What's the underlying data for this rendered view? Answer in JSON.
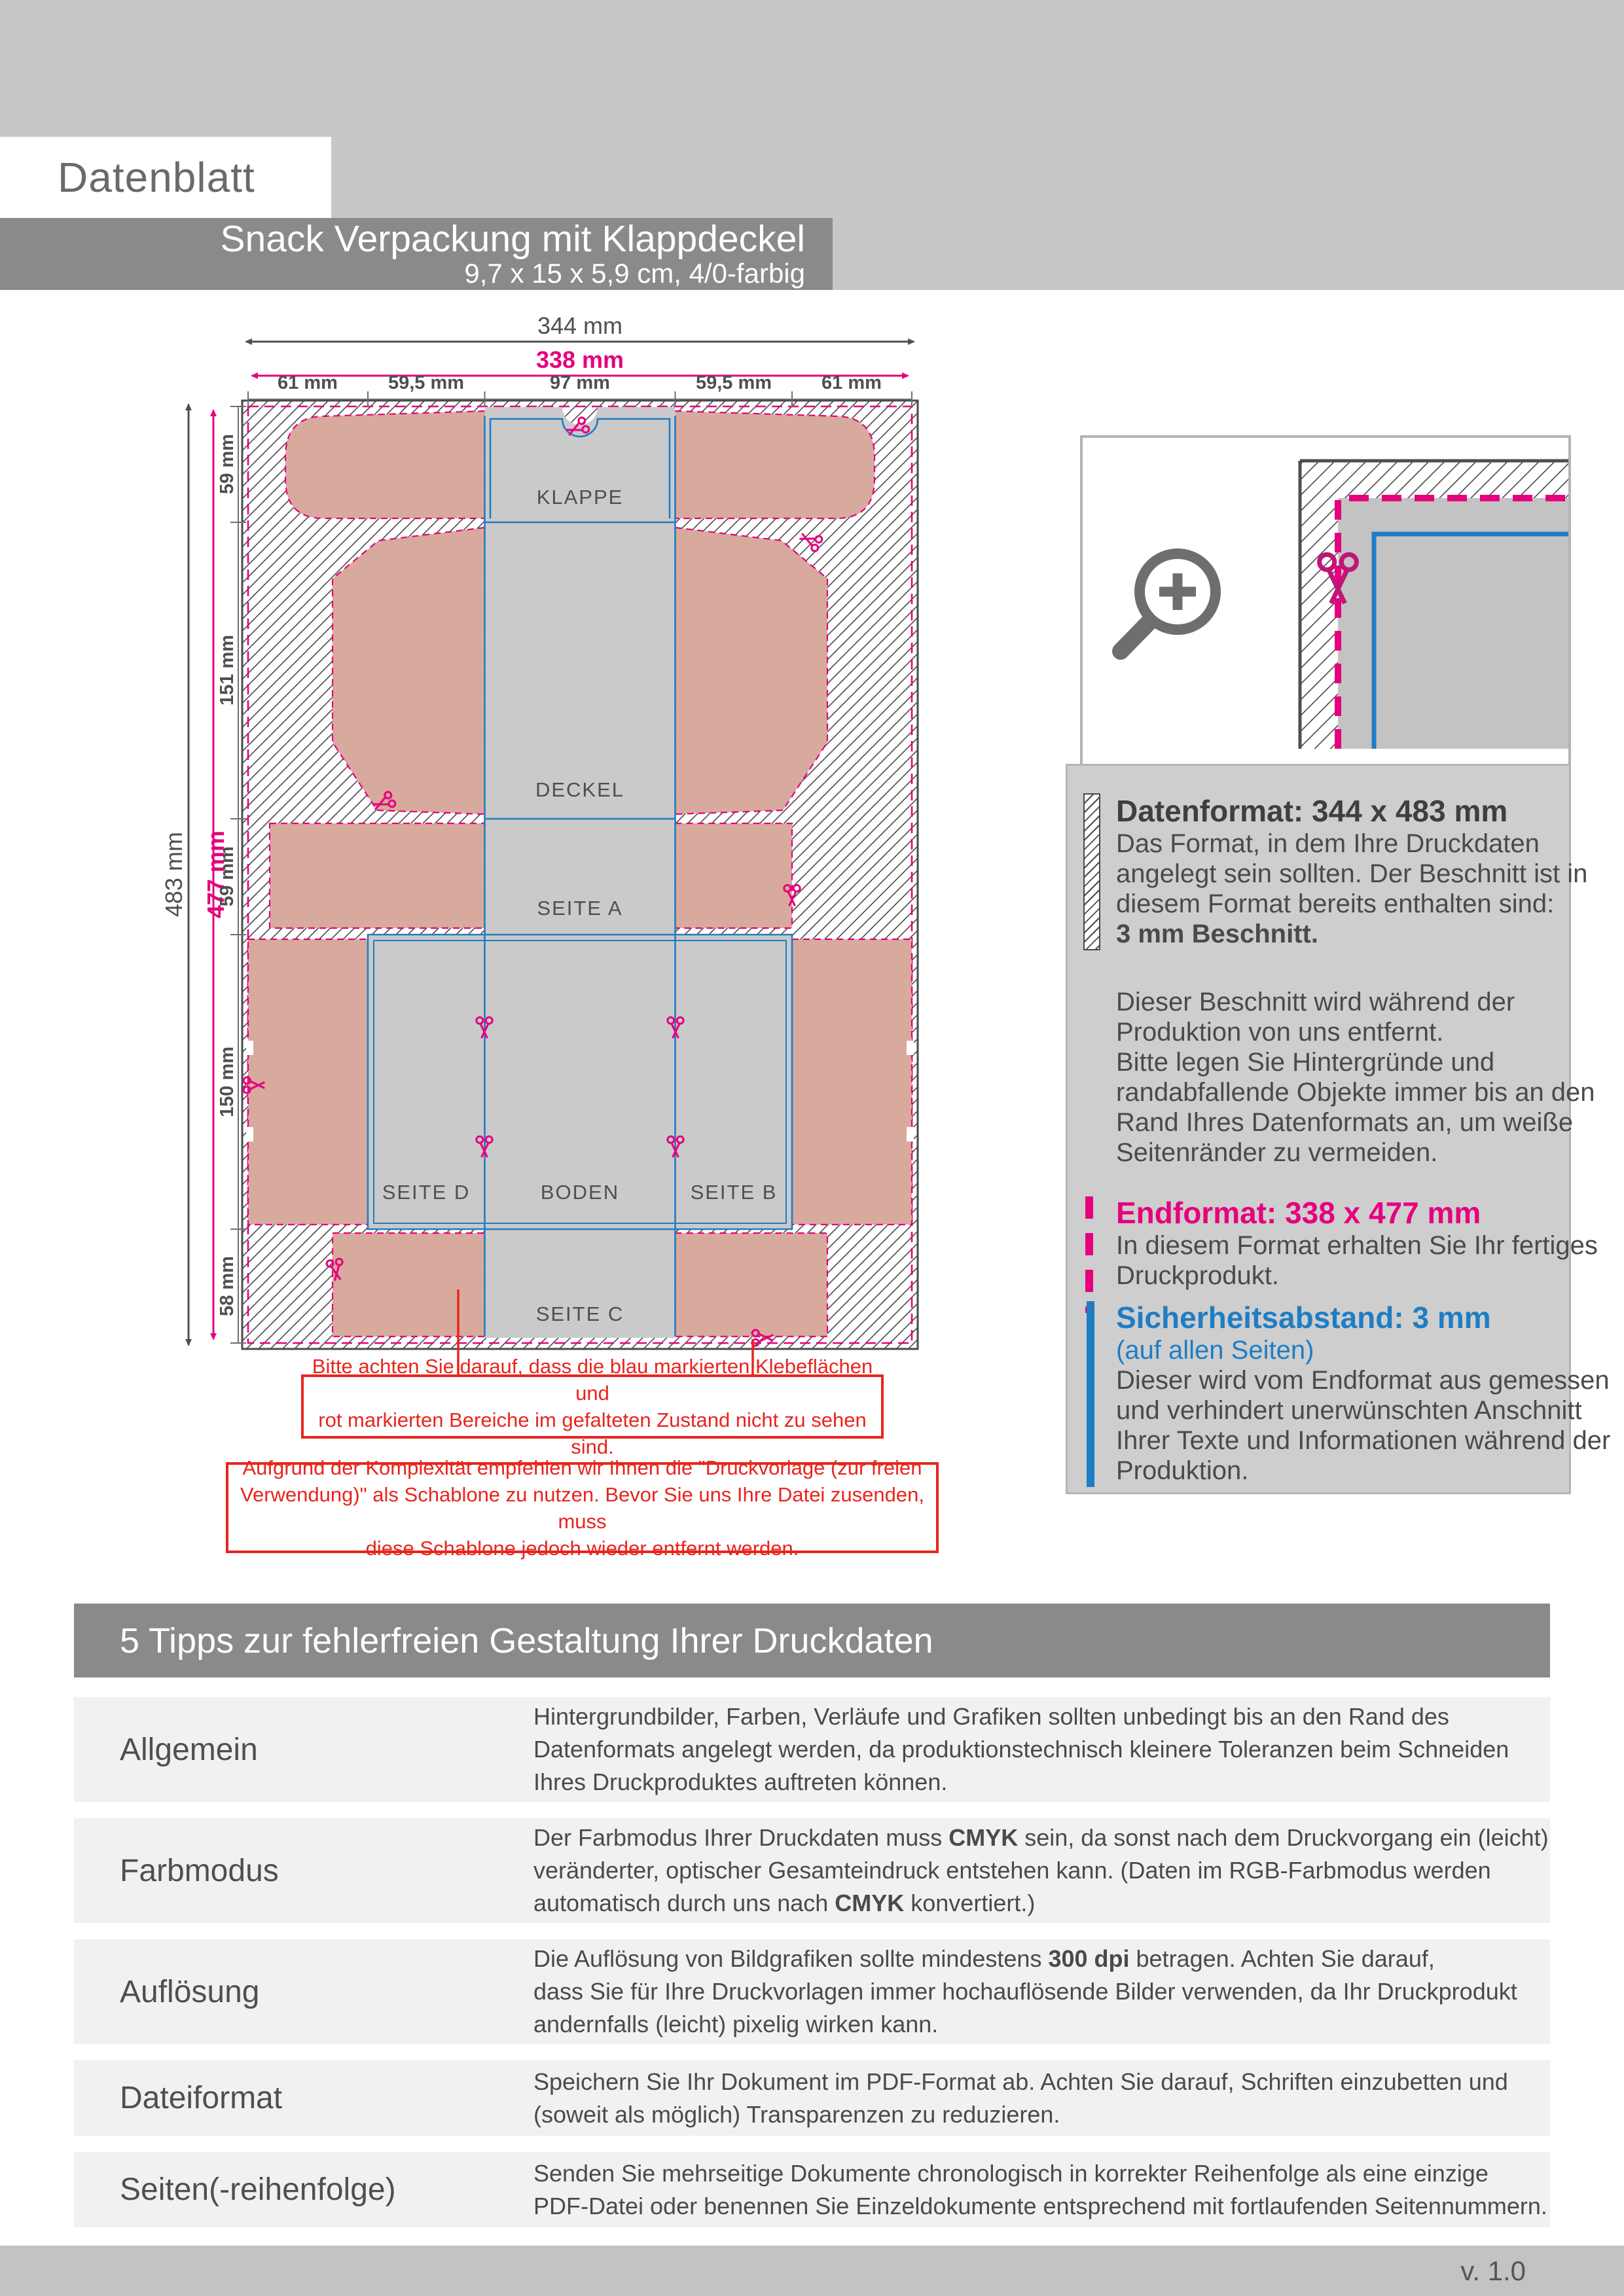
{
  "colors": {
    "magenta": "#e6007e",
    "blue": "#1f7dc4",
    "red": "#e8251d",
    "rose": "#d8a99d",
    "panel_gray": "#cacaca",
    "band_gray": "#c7c7c7",
    "banner_gray": "#8a8a8a"
  },
  "header": {
    "datenblatt": "Datenblatt",
    "title": "Snack Verpackung mit Klappdeckel",
    "subtitle": "9,7 x 15 x 5,9 cm, 4/0-farbig"
  },
  "diagram": {
    "dims": {
      "total_w": "344 mm",
      "trim_w": "338 mm",
      "cols": [
        "61 mm",
        "59,5 mm",
        "97 mm",
        "59,5 mm",
        "61 mm"
      ],
      "total_h": "483 mm",
      "trim_h": "477 mm",
      "rows": [
        "59 mm",
        "151 mm",
        "59 mm",
        "150 mm",
        "58 mm"
      ]
    },
    "panels": {
      "klappe": "KLAPPE",
      "deckel": "DECKEL",
      "seite_a": "SEITE A",
      "seite_d": "SEITE D",
      "boden": "BODEN",
      "seite_b": "SEITE B",
      "seite_c": "SEITE C"
    }
  },
  "info": {
    "datenformat": {
      "title": "Datenformat: 344 x 483 mm",
      "body": [
        [
          [
            "Das Format, in dem Ihre Druckdaten",
            0
          ]
        ],
        [
          [
            "angelegt sein sollten. Der Beschnitt ist in",
            0
          ]
        ],
        [
          [
            "diesem Format bereits enthalten sind:",
            0
          ]
        ],
        [
          [
            "3 mm Beschnitt.",
            1
          ]
        ]
      ],
      "body2": [
        "Dieser Beschnitt wird während der",
        "Produktion von uns entfernt.",
        "Bitte legen Sie Hintergründe und",
        "randabfallende Objekte immer bis an den",
        "Rand Ihres Datenformats an, um weiße",
        "Seitenränder zu vermeiden."
      ]
    },
    "endformat": {
      "title": "Endformat: 338 x 477 mm",
      "body": [
        "In diesem Format erhalten Sie Ihr fertiges",
        "Druckprodukt."
      ]
    },
    "sicherheit": {
      "title": "Sicherheitsabstand: 3 mm",
      "subtitle": "(auf allen Seiten)",
      "body": [
        "Dieser wird vom Endformat aus gemessen",
        "und verhindert unerwünschten Anschnitt",
        "Ihrer Texte und Informationen während der",
        "Produktion."
      ]
    }
  },
  "notes": {
    "note1": [
      "Bitte achten Sie darauf, dass die blau markierten Klebeflächen und",
      "rot markierten Bereiche im gefalteten Zustand nicht zu sehen sind."
    ],
    "note2": [
      "Aufgrund der Komplexität empfehlen wir Ihnen die \"Druckvorlage (zur freien",
      "Verwendung)\" als Schablone zu nutzen. Bevor Sie uns Ihre Datei zusenden, muss",
      "diese Schablone jedoch wieder entfernt werden."
    ]
  },
  "tips": {
    "title": "5 Tipps zur fehlerfreien Gestaltung Ihrer Druckdaten",
    "rows": [
      {
        "label": "Allgemein",
        "lines": [
          [
            [
              "Hintergrundbilder, Farben, Verläufe und Grafiken sollten unbedingt bis an den Rand des",
              0
            ]
          ],
          [
            [
              "Datenformats angelegt werden, da produktionstechnisch kleinere Toleranzen beim Schneiden",
              0
            ]
          ],
          [
            [
              "Ihres Druckproduktes auftreten können.",
              0
            ]
          ]
        ]
      },
      {
        "label": "Farbmodus",
        "lines": [
          [
            [
              "Der Farbmodus Ihrer Druckdaten muss ",
              0
            ],
            [
              "CMYK",
              1
            ],
            [
              " sein, da sonst nach dem Druckvorgang ein (leicht)",
              0
            ]
          ],
          [
            [
              "veränderter, optischer Gesamteindruck entstehen kann. (Daten im RGB-Farbmodus werden",
              0
            ]
          ],
          [
            [
              "automatisch durch uns nach ",
              0
            ],
            [
              "CMYK",
              1
            ],
            [
              " konvertiert.)",
              0
            ]
          ]
        ]
      },
      {
        "label": "Auflösung",
        "lines": [
          [
            [
              "Die Auflösung von Bildgrafiken sollte mindestens ",
              0
            ],
            [
              "300 dpi",
              1
            ],
            [
              " betragen. Achten Sie darauf,",
              0
            ]
          ],
          [
            [
              "dass Sie für Ihre Druckvorlagen immer hochauflösende Bilder verwenden, da Ihr Druckprodukt",
              0
            ]
          ],
          [
            [
              "andernfalls (leicht) pixelig wirken kann.",
              0
            ]
          ]
        ]
      },
      {
        "label": "Dateiformat",
        "lines": [
          [
            [
              "Speichern Sie Ihr Dokument im PDF-Format ab. Achten Sie darauf, Schriften einzubetten und",
              0
            ]
          ],
          [
            [
              "(soweit als möglich) Transparenzen zu reduzieren.",
              0
            ]
          ]
        ]
      },
      {
        "label": "Seiten(-reihenfolge)",
        "lines": [
          [
            [
              "Senden Sie mehrseitige Dokumente chronologisch in korrekter Reihenfolge als eine einzige",
              0
            ]
          ],
          [
            [
              "PDF-Datei oder benennen Sie Einzeldokumente entsprechend mit fortlaufenden Seitennummern.",
              0
            ]
          ]
        ]
      }
    ]
  },
  "footer": {
    "version": "v. 1.0"
  }
}
